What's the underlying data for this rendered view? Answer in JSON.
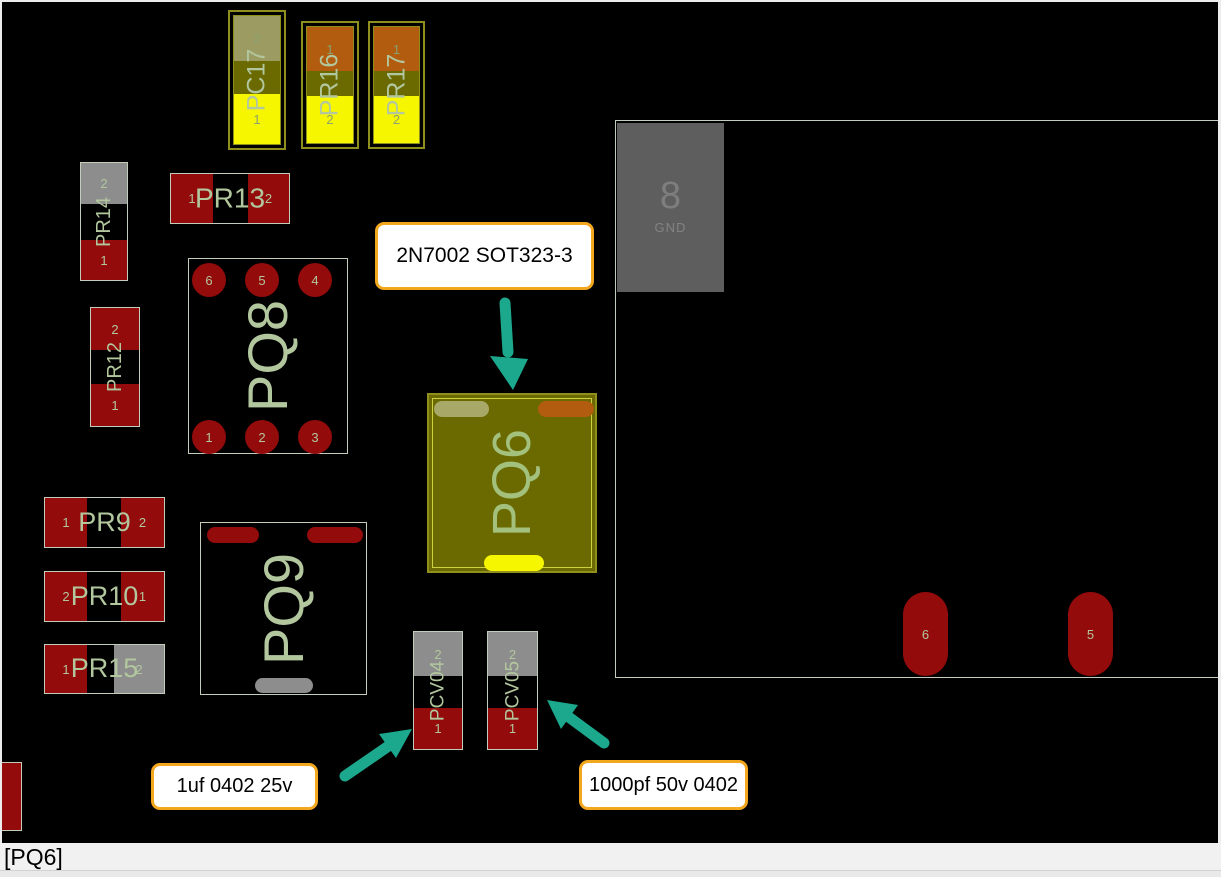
{
  "colors": {
    "pad-red": "#930b0b",
    "pad-gray": "#8d8d8d",
    "pad-yellow": "#f6f600",
    "pad-orange": "#b25c10",
    "pad-olive-gray": "#9c9c62",
    "pad-pale-olive": "#a8a868",
    "body-olive": "#6a6a00",
    "olive-border": "#8f8f1e",
    "inner-olive-line": "#cdd23e",
    "outline": "#c3cdbb",
    "silkscreen": "#b2c79e",
    "arrow-teal": "#1ba88c",
    "callout-border": "#f3a71f",
    "callout-bg": "#ffffff"
  },
  "components": {
    "pc17": {
      "label": "PC17",
      "top_pad": "2",
      "bottom_pad": "1"
    },
    "pr16": {
      "label": "PR16",
      "top_pad": "1",
      "bottom_pad": "2"
    },
    "pr17": {
      "label": "PR17",
      "top_pad": "1",
      "bottom_pad": "2"
    },
    "pr14": {
      "label": "PR14",
      "top_pad": "2",
      "bottom_pad": "1"
    },
    "pr13": {
      "label": "PR13",
      "left_pad": "1",
      "right_pad": "2"
    },
    "pr12": {
      "label": "PR12",
      "top_pad": "2",
      "bottom_pad": "1"
    },
    "pq8": {
      "label": "PQ8",
      "pads_top": [
        "6",
        "5",
        "4"
      ],
      "pads_bottom": [
        "1",
        "2",
        "3"
      ]
    },
    "pr9": {
      "label": "PR9",
      "left_pad": "1",
      "right_pad": "2"
    },
    "pr10": {
      "label": "PR10",
      "left_pad": "2",
      "right_pad": "1"
    },
    "pr15": {
      "label": "PR15",
      "left_pad": "1",
      "right_pad": "2"
    },
    "pq9": {
      "label": "PQ9"
    },
    "pq6": {
      "label": "PQ6"
    },
    "pcv04": {
      "label": "PCV04",
      "top_pad": "2",
      "bottom_pad": "1"
    },
    "pcv05": {
      "label": "PCV05",
      "top_pad": "2",
      "bottom_pad": "1"
    },
    "gnd": {
      "number": "8",
      "label": "GND"
    },
    "pad6": {
      "label": "6"
    },
    "pad5": {
      "label": "5"
    }
  },
  "callouts": {
    "transistor": {
      "text": "2N7002 SOT323-3"
    },
    "cap1uf": {
      "text": "1uf 0402 25v"
    },
    "cap1000pf": {
      "text": "1000pf 50v 0402"
    }
  },
  "statusbar": {
    "text": "[PQ6]"
  }
}
